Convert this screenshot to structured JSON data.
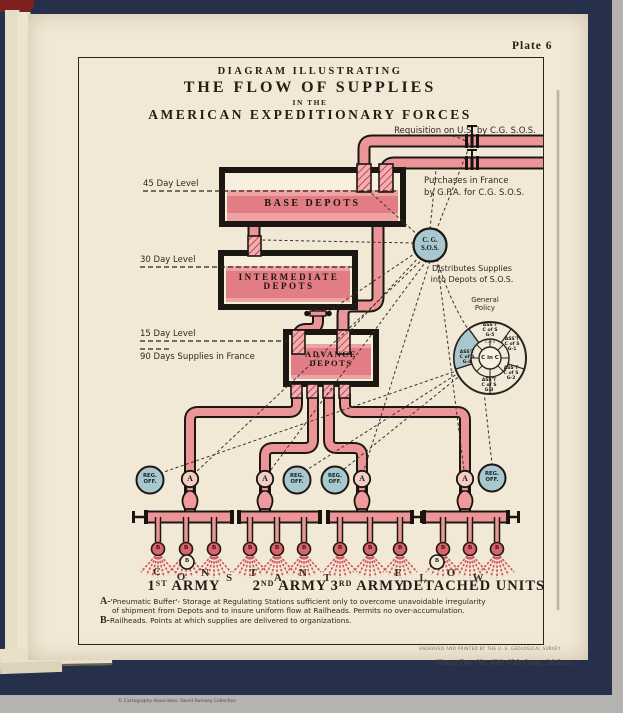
{
  "plate": {
    "label": "Plate 6"
  },
  "title": {
    "l1": "DIAGRAM ILLUSTRATING",
    "l2": "THE FLOW OF SUPPLIES",
    "l3": "IN THE",
    "l4": "AMERICAN EXPEDITIONARY FORCES"
  },
  "annotations": {
    "requisition": "Requisition on U.S. by C.G. S.O.S.",
    "purchases1": "Purchases in France",
    "purchases2": "by G.P.A. for C.G. S.O.S.",
    "distributes1": "Distributes Supplies",
    "distributes2": "into Depots of S.O.S.",
    "policy1": "General",
    "policy2": "Policy",
    "supplies90": "90 Days Supplies in France"
  },
  "levels": [
    {
      "label": "45 Day Level"
    },
    {
      "label": "30 Day Level"
    },
    {
      "label": "15 Day Level"
    }
  ],
  "tanks": {
    "base": "BASE DEPOTS",
    "intermediate1": "INTERMEDIATE",
    "intermediate2": "DEPOTS",
    "advance1": "ADVANCE",
    "advance2": "DEPOTS"
  },
  "cg": {
    "l1": "C. G.",
    "l2": "S.O.S."
  },
  "staff_wheel": {
    "center": "C in C",
    "ring": "C of S",
    "segments": [
      {
        "l1": "ASS'T",
        "l2": "C of S",
        "l3": "G-5"
      },
      {
        "l1": "ASS'T",
        "l2": "C of S",
        "l3": "G-1"
      },
      {
        "l1": "ASS'T",
        "l2": "C of S",
        "l3": "G-2"
      },
      {
        "l1": "ASS'T",
        "l2": "C of S",
        "l3": "G-3"
      },
      {
        "l1": "ASS'T",
        "l2": "C of S",
        "l3": "G-4"
      }
    ]
  },
  "regoff": {
    "l1": "REG.",
    "l2": "OFF."
  },
  "buffer_label": "A",
  "railhead_label": "B",
  "flow_letters": [
    "C",
    "O",
    "N",
    "S",
    "T",
    "A",
    "N",
    "T",
    "F",
    "L",
    "O",
    "W"
  ],
  "armies": [
    {
      "number": "1",
      "ordinal": "ST",
      "word": "ARMY"
    },
    {
      "number": "2",
      "ordinal": "ND",
      "word": "ARMY"
    },
    {
      "number": "3",
      "ordinal": "RD",
      "word": "ARMY"
    },
    {
      "label": "DETACHED UNITS"
    }
  ],
  "footnotes": {
    "a_prefix": "A-",
    "a1": "'Pneumatic Buffer'- Storage at Regulating Stations sufficient only to overcome unavoidable irregularity",
    "a2": "of shipment from Depots and to insure uniform flow at Railheads. Permits no over-accumulation.",
    "b_prefix": "B-",
    "b": "Railheads.  Points at which supplies are delivered to organizations."
  },
  "credits": {
    "engraver": "ENGRAVED AND PRINTED BY THE U. S. GEOLOGICAL SURVEY",
    "doc": "House Doc. No. 626; 65th Cong., 2d Sess.",
    "collection": "© Cartography Associates. David Rumsey Collection"
  },
  "colors": {
    "pipe_pink": "#ec9599",
    "tank_band": "#e27d86",
    "circle_blue": "#a9c7cf",
    "page_cream": "#f1e9d6",
    "cover_navy": "#26304a",
    "funnel_red": "#d9646c"
  }
}
